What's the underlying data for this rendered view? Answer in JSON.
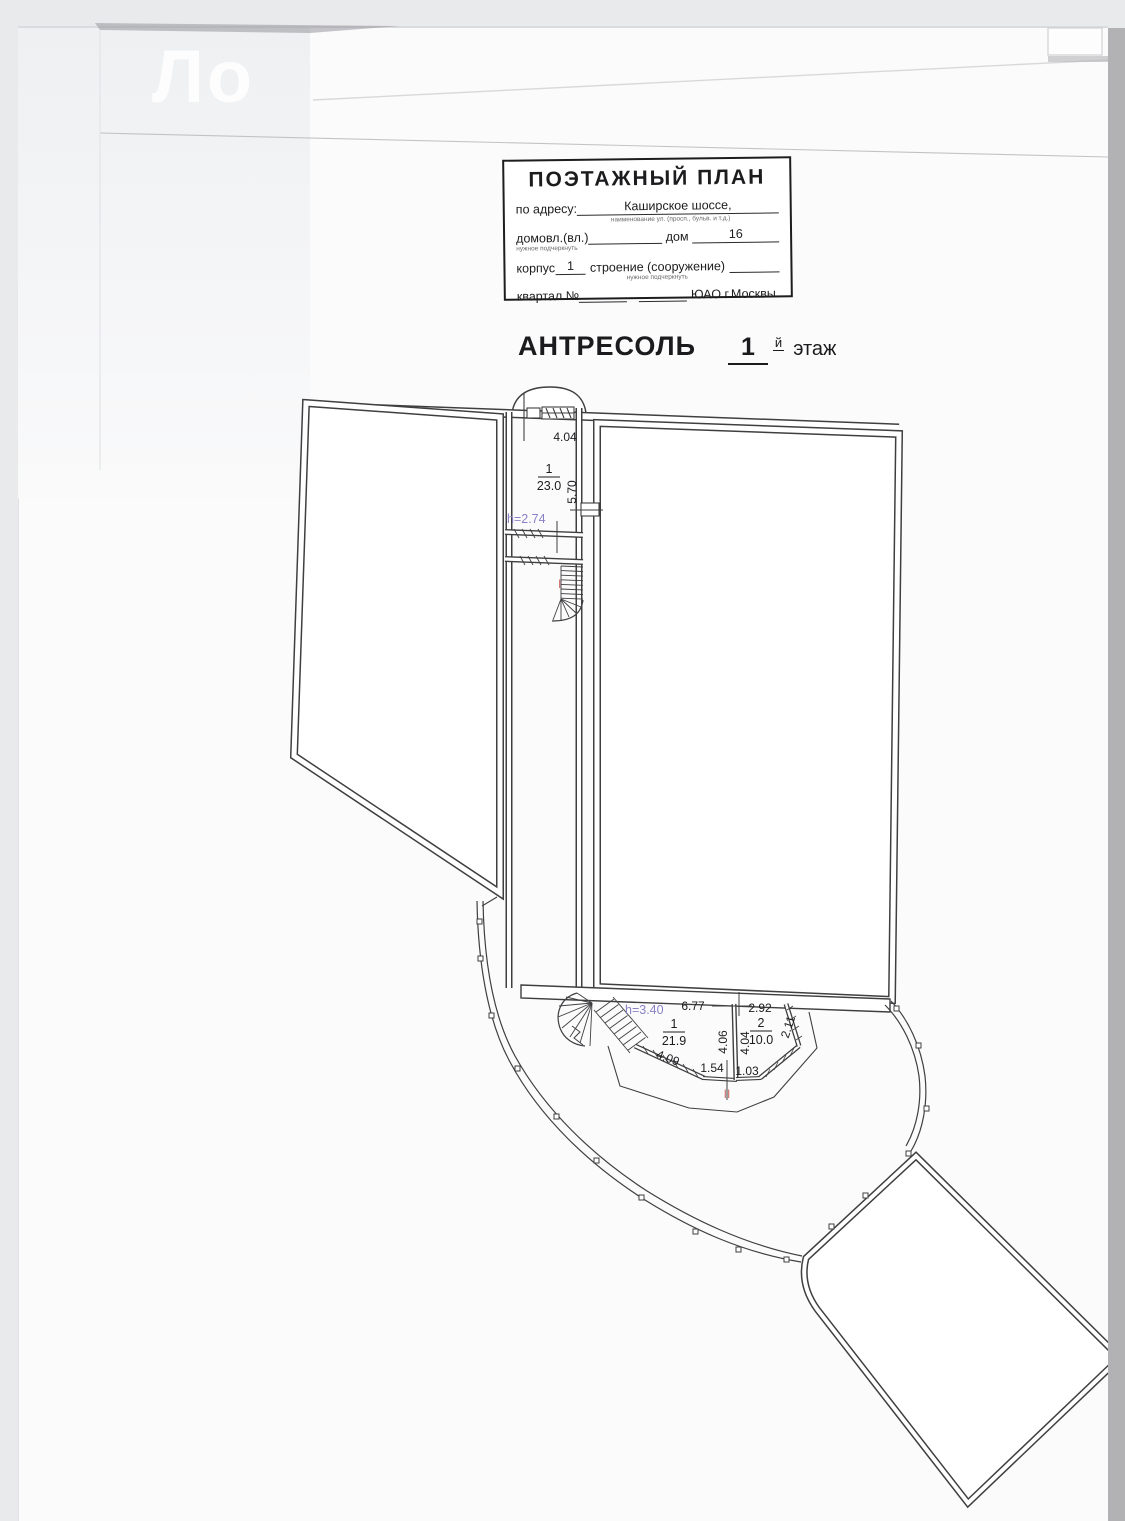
{
  "watermark": {
    "text": "Ло"
  },
  "stamp": {
    "title": "ПОЭТАЖНЫЙ ПЛАН",
    "address_label": "по адресу:",
    "address_value": "Каширское  шоссе,",
    "address_note": "наименование ул. (просп., бульв. и т.д.)",
    "ownership_label": "домовл.(вл.)",
    "ownership_note": "нужное подчеркнуть",
    "house_label": "дом",
    "house_value": "16",
    "building_label": "корпус",
    "building_value": "1",
    "structure_label": "строение (сооружение)",
    "structure_note": "нужное подчеркнуть",
    "block_label": "квартал №",
    "district": "ЮАО г.Москвы"
  },
  "heading": {
    "name": "АНТРЕСОЛЬ",
    "floor_number": "1",
    "floor_suffix": "й",
    "floor_word": "этаж"
  },
  "plan": {
    "colors": {
      "line": "#3f3f41",
      "height_label": "#8a82c8",
      "stair_mark": "#cf6f65"
    },
    "upper_room": {
      "width": "4.04",
      "number": "1",
      "area": "23.0",
      "depth": "5.70",
      "height": "h=2.74",
      "stair_mark": "I"
    },
    "lower": {
      "height": "h=3.40",
      "room1": {
        "number": "1",
        "area": "21.9",
        "width": "6.77",
        "depth": "4.06",
        "wall": "4.09",
        "door": "1.54"
      },
      "room2": {
        "number": "2",
        "area": "10.0",
        "width": "2.92",
        "depth": "4.04",
        "side": "2.11",
        "door": "1.03"
      },
      "stair_mark": "II"
    }
  }
}
